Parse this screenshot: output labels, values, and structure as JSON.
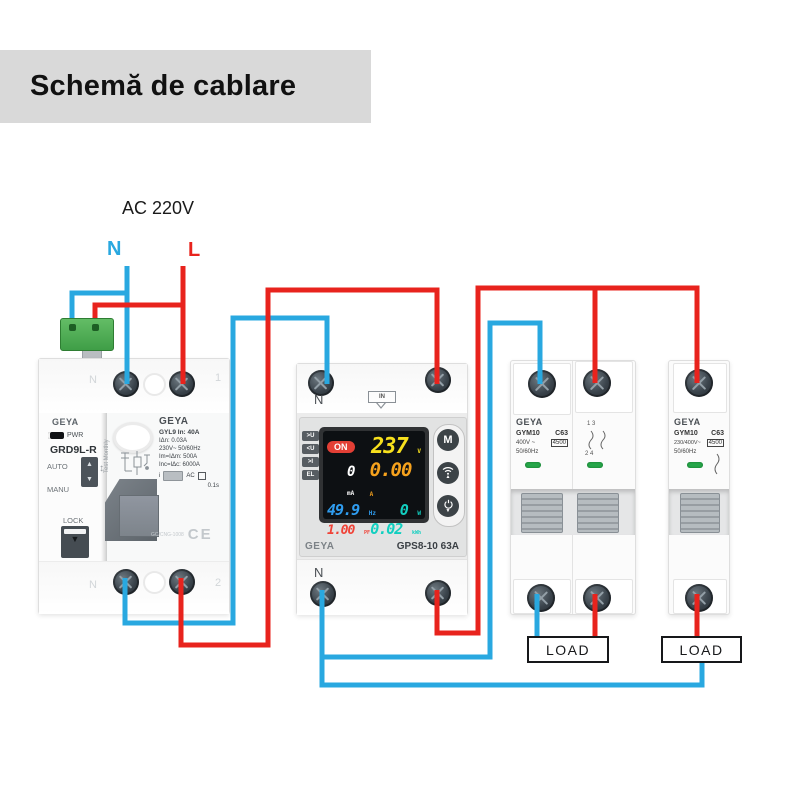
{
  "title": "Schemă de cablare",
  "supply": {
    "label": "AC 220V",
    "neutral": "N",
    "line": "L"
  },
  "colors": {
    "neutral_wire": "#29a8e0",
    "line_wire": "#e8231d",
    "banner_bg": "#d9d9d9",
    "indicator_green": "#27a74a",
    "display_on": "#e33f35",
    "display_voltage": "#f7e01d",
    "display_current": "#f6a21d",
    "display_freq": "#2f9df0",
    "display_cyan": "#12cfc0",
    "display_pf": "#f04237"
  },
  "rcd": {
    "brand": "GEYA",
    "power_led": "PWR",
    "model": "GRD9L-R",
    "auto": "AUTO",
    "manu": "MANU",
    "lock": "LOCK",
    "test_note": "Test Monthly",
    "label_brand": "GEYA",
    "specs": [
      "GYL9  In: 40A",
      "IΔn: 0.03A",
      "230V~ 50/60Hz",
      "Im=IΔm: 500A",
      "Inc=IΔc: 6000A"
    ],
    "type": "AC",
    "trip_time": "0.1s",
    "cert_code": "GC/CNG-1008",
    "ce": "CE",
    "terminals": {
      "top_left": "N",
      "top_right": "1",
      "bottom_left": "N",
      "bottom_right": "2"
    }
  },
  "protector": {
    "input_terminal": "N",
    "input_badge": "IN",
    "output_terminal": "N",
    "brand": "GEYA",
    "model": "GPS8-10 63A",
    "side_badges": [
      ">U",
      "<U",
      ">I",
      "EL"
    ],
    "display": {
      "status": "ON",
      "voltage": "237",
      "voltage_unit": "V",
      "leakage": "0",
      "leakage_unit": "mA",
      "current": "0.00",
      "current_unit": "A",
      "frequency": "49.9",
      "frequency_unit": "Hz",
      "power": "0",
      "power_unit": "W",
      "power_factor": "1.00",
      "power_factor_unit": "PF",
      "energy": "0.02",
      "energy_unit": "kWh"
    },
    "buttons": {
      "mode": "M"
    }
  },
  "breaker_2p": {
    "brand": "GEYA",
    "model": "GYM10",
    "curve": "C63",
    "voltage": "400V ~",
    "breaking_capacity": "4500",
    "frequency": "50/60Hz",
    "pole_marks_top": "1  3",
    "pole_marks_bottom": "2  4"
  },
  "breaker_1p": {
    "brand": "GEYA",
    "model": "GYM10",
    "curve": "C63",
    "voltage": "230/400V~",
    "breaking_capacity": "4500",
    "frequency": "50/60Hz"
  },
  "loads": {
    "left": "LOAD",
    "right": "LOAD"
  }
}
